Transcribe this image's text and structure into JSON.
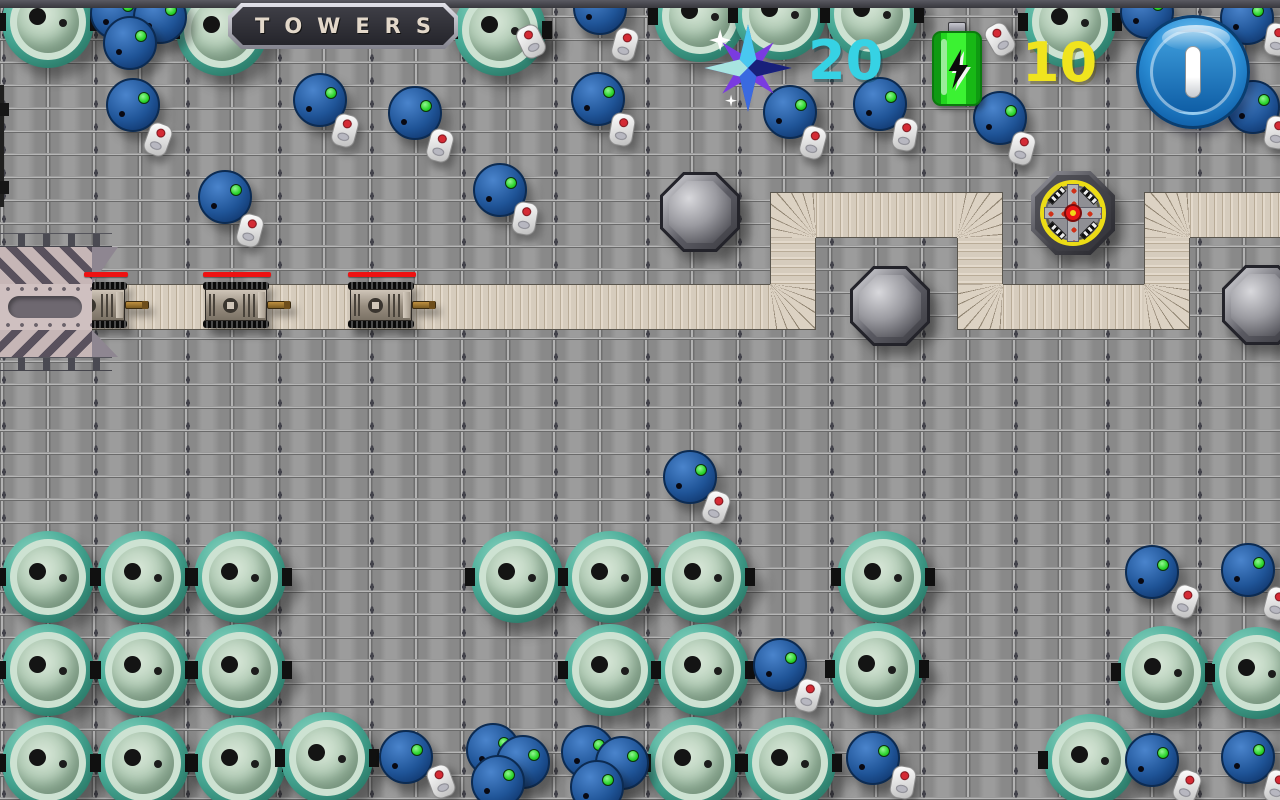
{
  "hud": {
    "sign_title": "TOWERS",
    "score": {
      "icon": "crystal-star-icon",
      "value": "20",
      "color": "#36d2e4"
    },
    "energy": {
      "icon": "battery-icon",
      "value": "10",
      "color": "#f0e41e"
    },
    "pause_label": "pause"
  },
  "palette": {
    "floor": "#8f8f8f",
    "path": "#dcd2c3",
    "vat_rim": "#3e9f8d",
    "barrel_blue": "#1f5497",
    "led_green": "#2ad42a",
    "health_red": "#ee1212",
    "tower_ring_yellow": "#ecdc16"
  },
  "map": {
    "path_segments": [
      {
        "x": 88,
        "y": 284,
        "w": 682,
        "h": 46,
        "k": "h"
      },
      {
        "x": 770,
        "y": 284,
        "w": 46,
        "h": 46,
        "k": "ctl"
      },
      {
        "x": 770,
        "y": 238,
        "w": 46,
        "h": 46,
        "k": "v"
      },
      {
        "x": 770,
        "y": 192,
        "w": 46,
        "h": 46,
        "k": "cbr"
      },
      {
        "x": 816,
        "y": 192,
        "w": 141,
        "h": 46,
        "k": "h"
      },
      {
        "x": 957,
        "y": 192,
        "w": 46,
        "h": 46,
        "k": "cbl"
      },
      {
        "x": 957,
        "y": 238,
        "w": 46,
        "h": 46,
        "k": "v"
      },
      {
        "x": 957,
        "y": 284,
        "w": 46,
        "h": 46,
        "k": "ctr"
      },
      {
        "x": 1003,
        "y": 284,
        "w": 141,
        "h": 46,
        "k": "h"
      },
      {
        "x": 1144,
        "y": 284,
        "w": 46,
        "h": 46,
        "k": "ctl"
      },
      {
        "x": 1144,
        "y": 238,
        "w": 46,
        "h": 46,
        "k": "v"
      },
      {
        "x": 1144,
        "y": 192,
        "w": 46,
        "h": 46,
        "k": "cbr"
      },
      {
        "x": 1190,
        "y": 192,
        "w": 90,
        "h": 46,
        "k": "h"
      }
    ],
    "tower_sockets": [
      {
        "x": 700,
        "y": 212
      },
      {
        "x": 890,
        "y": 306
      },
      {
        "x": 1262,
        "y": 305
      }
    ],
    "towers": [
      {
        "kind": "tesla",
        "x": 1073,
        "y": 213
      }
    ],
    "tanks": [
      {
        "x": 95,
        "y": 305
      },
      {
        "x": 237,
        "y": 305
      },
      {
        "x": 382,
        "y": 305
      }
    ],
    "health_bars": [
      {
        "x": 84,
        "y": 272,
        "w": 44
      },
      {
        "x": 203,
        "y": 272,
        "w": 68
      },
      {
        "x": 348,
        "y": 272,
        "w": 68
      }
    ],
    "vats": [
      {
        "x": 48,
        "y": 22
      },
      {
        "x": 222,
        "y": 30
      },
      {
        "x": 500,
        "y": 30
      },
      {
        "x": 700,
        "y": 16
      },
      {
        "x": 780,
        "y": 14
      },
      {
        "x": 872,
        "y": 14
      },
      {
        "x": 1070,
        "y": 22
      },
      {
        "x": 48,
        "y": 577
      },
      {
        "x": 143,
        "y": 577
      },
      {
        "x": 240,
        "y": 577
      },
      {
        "x": 48,
        "y": 670
      },
      {
        "x": 143,
        "y": 670
      },
      {
        "x": 240,
        "y": 670
      },
      {
        "x": 48,
        "y": 763
      },
      {
        "x": 143,
        "y": 763
      },
      {
        "x": 240,
        "y": 763
      },
      {
        "x": 327,
        "y": 758
      },
      {
        "x": 517,
        "y": 577
      },
      {
        "x": 610,
        "y": 577
      },
      {
        "x": 703,
        "y": 577
      },
      {
        "x": 883,
        "y": 577
      },
      {
        "x": 610,
        "y": 670
      },
      {
        "x": 703,
        "y": 670
      },
      {
        "x": 877,
        "y": 669
      },
      {
        "x": 693,
        "y": 763
      },
      {
        "x": 790,
        "y": 763
      },
      {
        "x": 1163,
        "y": 672
      },
      {
        "x": 1257,
        "y": 673
      },
      {
        "x": 1090,
        "y": 760
      }
    ],
    "barrels": [
      {
        "x": 117,
        "y": 13
      },
      {
        "x": 160,
        "y": 17
      },
      {
        "x": 130,
        "y": 43
      },
      {
        "x": 600,
        "y": 8
      },
      {
        "x": 1147,
        "y": 12
      },
      {
        "x": 1247,
        "y": 18
      },
      {
        "x": 133,
        "y": 105
      },
      {
        "x": 320,
        "y": 100
      },
      {
        "x": 415,
        "y": 113
      },
      {
        "x": 598,
        "y": 99
      },
      {
        "x": 790,
        "y": 112
      },
      {
        "x": 880,
        "y": 104
      },
      {
        "x": 1000,
        "y": 118
      },
      {
        "x": 1253,
        "y": 107
      },
      {
        "x": 225,
        "y": 197
      },
      {
        "x": 500,
        "y": 190
      },
      {
        "x": 690,
        "y": 477
      },
      {
        "x": 406,
        "y": 757
      },
      {
        "x": 780,
        "y": 665
      },
      {
        "x": 873,
        "y": 758
      },
      {
        "x": 493,
        "y": 750
      },
      {
        "x": 523,
        "y": 762
      },
      {
        "x": 498,
        "y": 782
      },
      {
        "x": 588,
        "y": 752
      },
      {
        "x": 622,
        "y": 763
      },
      {
        "x": 597,
        "y": 787
      },
      {
        "x": 1152,
        "y": 572
      },
      {
        "x": 1248,
        "y": 570
      },
      {
        "x": 1152,
        "y": 760
      },
      {
        "x": 1248,
        "y": 757
      }
    ],
    "capsules": [
      {
        "x": 531,
        "y": 42,
        "rot": -25
      },
      {
        "x": 625,
        "y": 45,
        "rot": 15
      },
      {
        "x": 1000,
        "y": 40,
        "rot": -30
      },
      {
        "x": 1277,
        "y": 40,
        "rot": 10
      },
      {
        "x": 158,
        "y": 140,
        "rot": 20
      },
      {
        "x": 345,
        "y": 131,
        "rot": 15
      },
      {
        "x": 440,
        "y": 146,
        "rot": 15
      },
      {
        "x": 622,
        "y": 130,
        "rot": 10
      },
      {
        "x": 813,
        "y": 143,
        "rot": 15
      },
      {
        "x": 905,
        "y": 135,
        "rot": 10
      },
      {
        "x": 1022,
        "y": 149,
        "rot": 15
      },
      {
        "x": 1277,
        "y": 133,
        "rot": 10
      },
      {
        "x": 250,
        "y": 231,
        "rot": 15
      },
      {
        "x": 525,
        "y": 219,
        "rot": 10
      },
      {
        "x": 716,
        "y": 508,
        "rot": 20
      },
      {
        "x": 441,
        "y": 782,
        "rot": -20
      },
      {
        "x": 808,
        "y": 696,
        "rot": 15
      },
      {
        "x": 903,
        "y": 783,
        "rot": 10
      },
      {
        "x": 1185,
        "y": 602,
        "rot": 20
      },
      {
        "x": 1277,
        "y": 604,
        "rot": 15
      },
      {
        "x": 1187,
        "y": 787,
        "rot": 20
      },
      {
        "x": 1277,
        "y": 787,
        "rot": 15
      }
    ]
  }
}
